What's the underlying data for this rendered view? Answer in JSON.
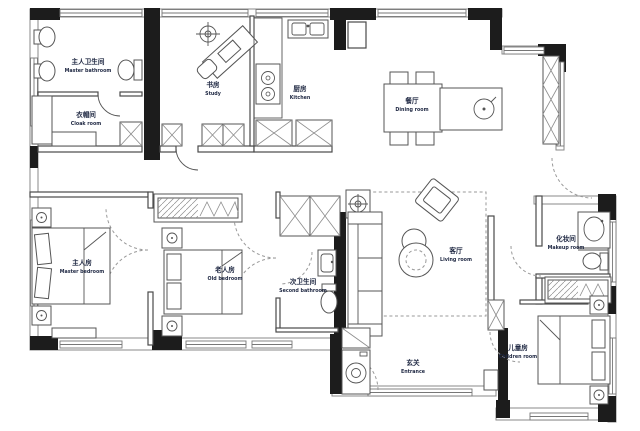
{
  "plan_title": "apartment-floor-plan",
  "colors": {
    "wall": "#1c1c1c",
    "line": "#4a4a4a",
    "window": "#777777",
    "label": "#1e2742",
    "background": "#ffffff"
  },
  "rooms": {
    "master_bathroom": {
      "zh": "主人卫生间",
      "en": "Master bathroom"
    },
    "cloak_room": {
      "zh": "衣帽间",
      "en": "Cloak room"
    },
    "study": {
      "zh": "书房",
      "en": "Study"
    },
    "kitchen": {
      "zh": "厨房",
      "en": "Kitchen"
    },
    "dining_room": {
      "zh": "餐厅",
      "en": "Dining room"
    },
    "master_bedroom": {
      "zh": "主人房",
      "en": "Master bedroom"
    },
    "old_bedroom": {
      "zh": "老人房",
      "en": "Old bedroom"
    },
    "second_bathroom": {
      "zh": "次卫生间",
      "en": "Second bathroom"
    },
    "living_room": {
      "zh": "客厅",
      "en": "Living room"
    },
    "makeup_room": {
      "zh": "化妆间",
      "en": "Makeup room"
    },
    "children_room": {
      "zh": "儿童房",
      "en": "Children room"
    },
    "entrance": {
      "zh": "玄关",
      "en": "Entrance"
    }
  }
}
